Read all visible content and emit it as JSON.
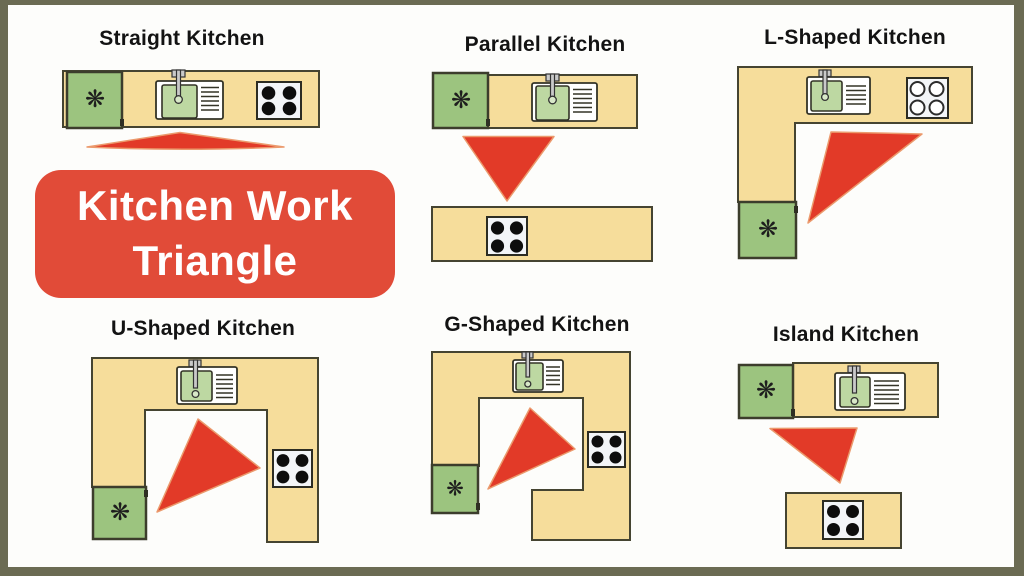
{
  "page": {
    "background": "#fdfdfb",
    "frame_color": "#6b6b53"
  },
  "badge": {
    "line1": "Kitchen Work",
    "line2": "Triangle",
    "bg_color": "#e14b38",
    "text_color": "#ffffff"
  },
  "layouts": [
    {
      "id": "straight",
      "title": "Straight Kitchen"
    },
    {
      "id": "parallel",
      "title": "Parallel Kitchen"
    },
    {
      "id": "l-shaped",
      "title": "L-Shaped Kitchen"
    },
    {
      "id": "u-shaped",
      "title": "U-Shaped Kitchen"
    },
    {
      "id": "g-shaped",
      "title": "G-Shaped Kitchen"
    },
    {
      "id": "island",
      "title": "Island Kitchen"
    }
  ],
  "icons": {
    "fridge_fan": "❋"
  },
  "colors": {
    "counter": "#f6dd9b",
    "fridge_green": "#9cc47f",
    "sink_basin": "#bdd8a2",
    "work_triangle_red": "#e23a28",
    "title_text": "#131313"
  }
}
